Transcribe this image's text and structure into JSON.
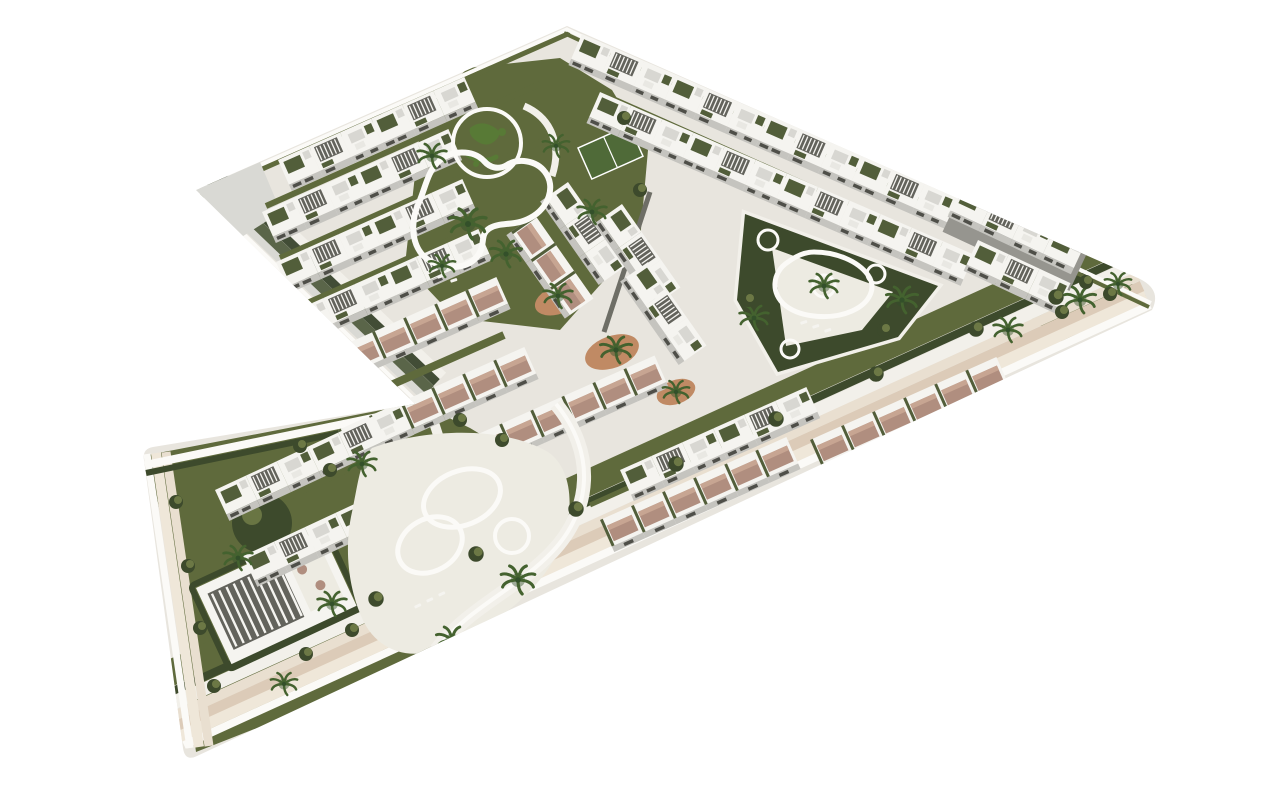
{
  "meta": {
    "title": "Aerial 3D architectural render of a white Mediterranean residential resort on an L-shaped parcel",
    "description": "Isometric bird's-eye rendering of a new-build apartment complex on a cream plinth over a white background. Rows of white flat-roof buildings with roof gardens, pergolas and terracotta roof terraces surround three turquoise pool gardens with palm trees and dark green hedges.",
    "view": "isometric aerial",
    "background_style": "plain white studio background"
  },
  "colors": {
    "background": "#ffffff",
    "platform_top": "#e8e5de",
    "rim_white": "#fbfaf7",
    "side_cream": "#efe7d9",
    "side_beige": "#dccbb8",
    "side_cream2": "#e9dfd0",
    "promenade": "#f2f0ea",
    "corner_wedge": "#d9d9d4",
    "olive": "#5a6549",
    "olive_dark": "#424d36",
    "lawn": "#5f6a3c",
    "lawn_light": "#74804a",
    "hedge": "#3d4a2c",
    "putting_green": "#a8c366",
    "putting_dark": "#587a36",
    "court": "#4f6a38",
    "water": "#35aac4",
    "water_mid": "#5ec6d6",
    "water_light": "#c2ecef",
    "spa": "#2493cc",
    "deck": "#edebe2",
    "bld_white": "#f5f4f0",
    "bld_white2": "#e9e8e3",
    "face": "#c5c4bf",
    "face_dark": "#96958f",
    "win": "#4f4f49",
    "roof_gray": "#d8d7d2",
    "roof_green": "#525e3a",
    "pergola": "#63635c",
    "terracotta": "#b08e7f",
    "terracotta_light": "#c7a592",
    "gravel": "#c08a64",
    "palm": "#44622f",
    "palm_dark": "#33502a",
    "lane": "#6e6e66"
  },
  "scene": {
    "parcel": {
      "shape": "L-shaped (boomerang) plot pointing right, lower wing pointing down-left",
      "plinth": "cream and beige layered base with dark olive embankment on the north-west wall",
      "edge_feature": "white perimeter promenade with continuous hedge"
    },
    "amenities": [
      {
        "id": "lagoon-pool",
        "label": "Lagoon-style main pool with white beach edge, sun loungers and palm trees"
      },
      {
        "id": "putting-green",
        "label": "Circular putting green with dark green contoured bunkers"
      },
      {
        "id": "island-pool",
        "label": "Rounded triangular pool with central palm island",
        "spa_pools": 3
      },
      {
        "id": "family-pool",
        "label": "Free-form double-lobe pool with round children's pool and curved paths"
      },
      {
        "id": "clubhouse",
        "label": "Club house with white slatted pergola and terrace tables"
      },
      {
        "id": "sports-court",
        "label": "Green multi-sport lawn court"
      },
      {
        "id": "gravel-gardens",
        "label": "Orange gravel planting beds with palms"
      }
    ],
    "buildings": {
      "style": "white flat-roof Mediterranean blocks with roof gardens, slatted pergolas and terracotta roof terraces",
      "clusters": [
        {
          "id": "northwest-rows",
          "label": "Terraced apartment rows, north-west block",
          "rows": 5
        },
        {
          "id": "north-edge-rows",
          "label": "Long apartment rows along the north edge",
          "rows": 2
        },
        {
          "id": "central-columns",
          "label": "Central three-storey apartment columns",
          "rows": 4
        },
        {
          "id": "south-rows",
          "label": "Townhouse rows with terracotta roof terraces along the south promenade",
          "rows": 5
        },
        {
          "id": "east-tip-cluster",
          "label": "Apartment cluster near the east tip",
          "rows": 2
        },
        {
          "id": "southwest-wing-rows",
          "label": "Townhouse rows in the lower wing",
          "rows": 2
        }
      ]
    },
    "vegetation": {
      "palms": 20,
      "shrubs": "dark green clipped bushes along promenades",
      "lawns": "olive green communal gardens"
    }
  }
}
